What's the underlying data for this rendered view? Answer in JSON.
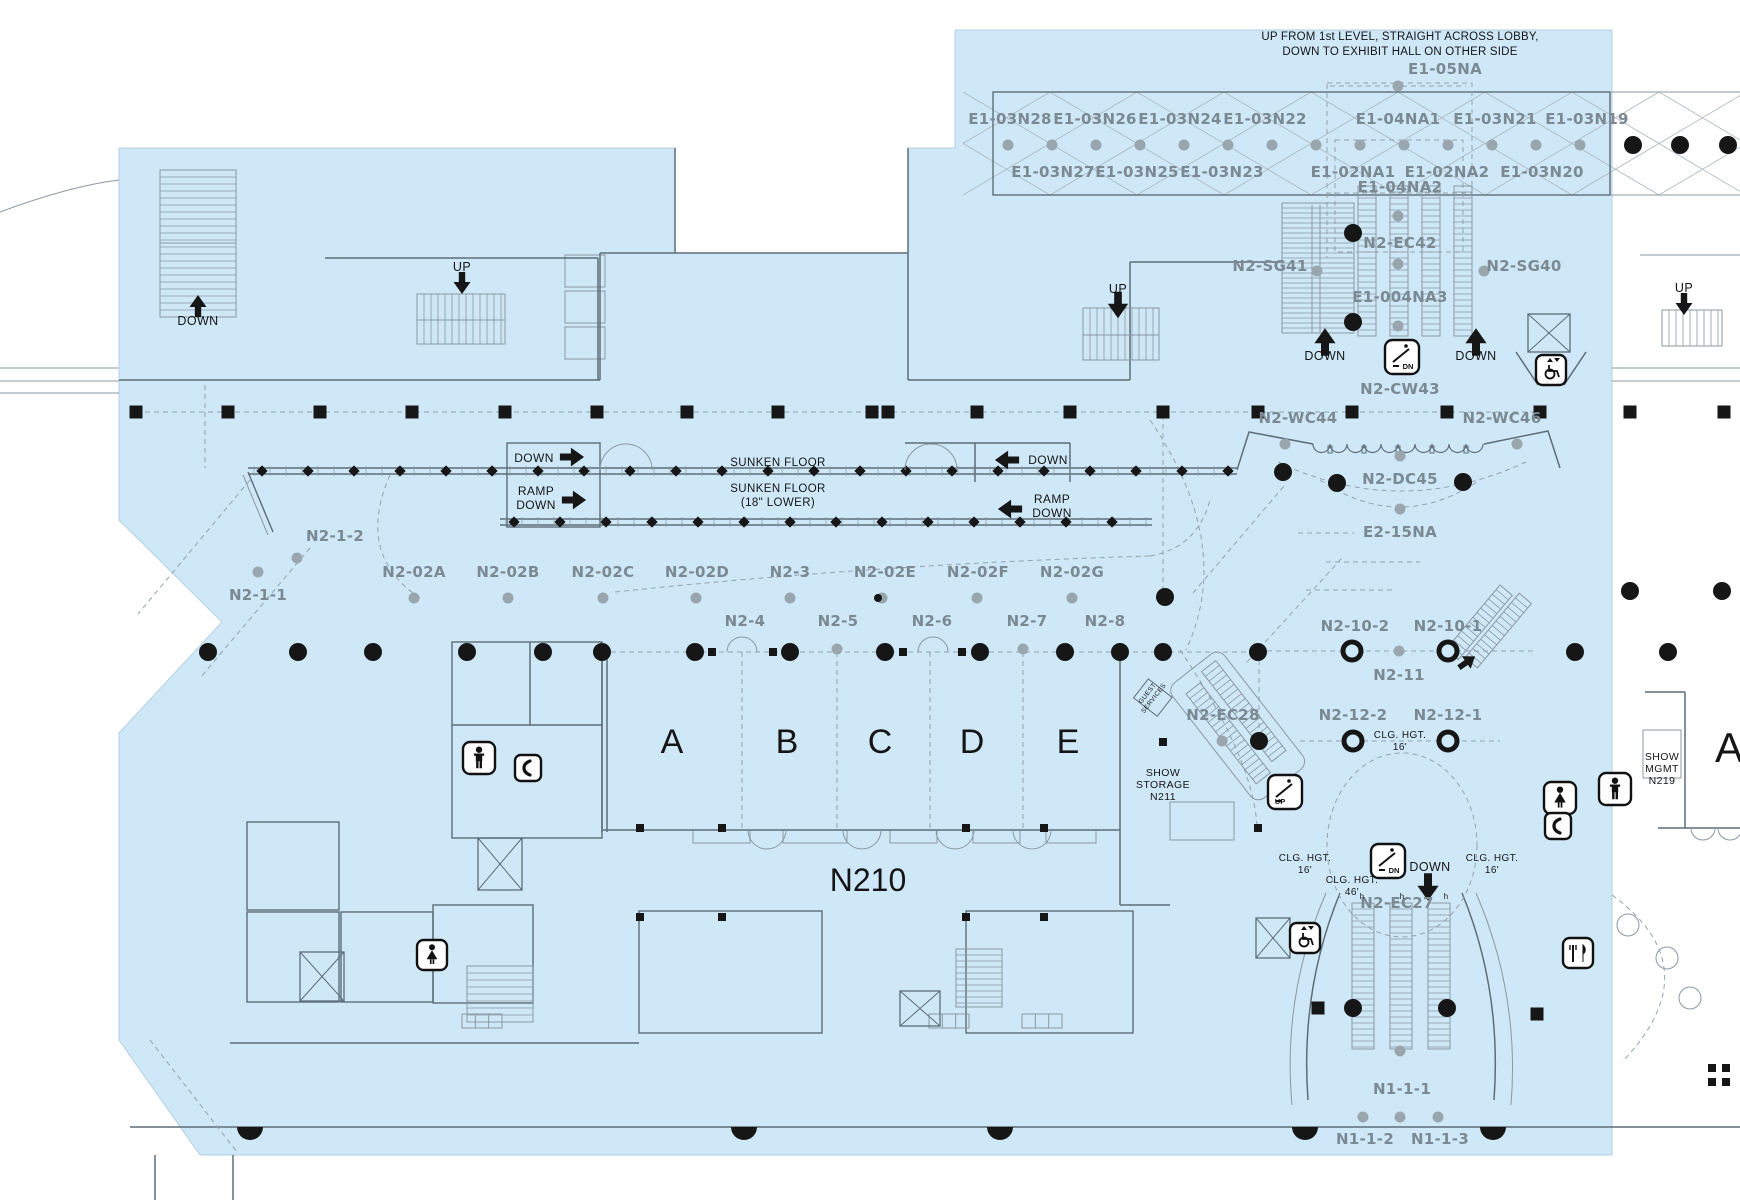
{
  "canvas": {
    "w": 1740,
    "h": 1200
  },
  "colors": {
    "floor": "#cfe8f8",
    "bg": "#ffffff",
    "wall": "#5d6d78",
    "line": "#8a98a2",
    "dash": "#93a2ab",
    "black": "#161616",
    "gray_label": "#7b8992",
    "dot": "#9aa6ad"
  },
  "header_note": {
    "line1": "UP FROM 1st LEVEL, STRAIGHT ACROSS LOBBY,",
    "line2": "DOWN TO EXHIBIT HALL ON OTHER SIDE"
  },
  "floor_polygon": [
    [
      119,
      148
    ],
    [
      675,
      148
    ],
    [
      675,
      253
    ],
    [
      908,
      253
    ],
    [
      908,
      148
    ],
    [
      955,
      148
    ],
    [
      955,
      30
    ],
    [
      1612,
      30
    ],
    [
      1612,
      1155
    ],
    [
      200,
      1155
    ],
    [
      119,
      1040
    ],
    [
      119,
      733
    ],
    [
      222,
      622
    ],
    [
      119,
      520
    ]
  ],
  "room_codes": [
    [
      "E1-05NA",
      1445,
      74
    ],
    [
      "E1-03N28",
      1010,
      124
    ],
    [
      "E1-03N26",
      1095,
      124
    ],
    [
      "E1-03N24",
      1180,
      124
    ],
    [
      "E1-03N22",
      1265,
      124
    ],
    [
      "E1-04NA1",
      1398,
      124
    ],
    [
      "E1-03N21",
      1495,
      124
    ],
    [
      "E1-03N19",
      1587,
      124
    ],
    [
      "E1-03N27",
      1053,
      177
    ],
    [
      "E1-03N25",
      1137,
      177
    ],
    [
      "E1-03N23",
      1222,
      177
    ],
    [
      "E1-02NA1",
      1353,
      177
    ],
    [
      "E1-02NA2",
      1447,
      177
    ],
    [
      "E1-03N20",
      1542,
      177
    ],
    [
      "E1-04NA2",
      1400,
      192
    ],
    [
      "N2-EC42",
      1400,
      248
    ],
    [
      "N2-SG41",
      1270,
      271
    ],
    [
      "N2-SG40",
      1524,
      271
    ],
    [
      "E1-004NA3",
      1400,
      302
    ],
    [
      "N2-CW43",
      1400,
      394
    ],
    [
      "N2-WC44",
      1298,
      423
    ],
    [
      "N2-WC46",
      1502,
      423
    ],
    [
      "N2-DC45",
      1400,
      484
    ],
    [
      "E2-15NA",
      1400,
      537
    ],
    [
      "N2-1-2",
      335,
      541
    ],
    [
      "N2-1-1",
      258,
      600
    ],
    [
      "N2-02A",
      414,
      577
    ],
    [
      "N2-02B",
      508,
      577
    ],
    [
      "N2-02C",
      603,
      577
    ],
    [
      "N2-02D",
      697,
      577
    ],
    [
      "N2-3",
      790,
      577
    ],
    [
      "N2-02E",
      885,
      577
    ],
    [
      "N2-02F",
      978,
      577
    ],
    [
      "N2-02G",
      1072,
      577
    ],
    [
      "N2-4",
      745,
      626
    ],
    [
      "N2-5",
      838,
      626
    ],
    [
      "N2-6",
      932,
      626
    ],
    [
      "N2-7",
      1027,
      626
    ],
    [
      "N2-8",
      1105,
      626
    ],
    [
      "N2-10-2",
      1355,
      631
    ],
    [
      "N2-10-1",
      1448,
      631
    ],
    [
      "N2-11",
      1399,
      680
    ],
    [
      "N2-12-2",
      1353,
      720
    ],
    [
      "N2-12-1",
      1448,
      720
    ],
    [
      "N2-EC28",
      1223,
      720
    ],
    [
      "N2-EC27",
      1397,
      908
    ],
    [
      "N1-1-1",
      1402,
      1094
    ],
    [
      "N1-1-2",
      1365,
      1144
    ],
    [
      "N1-1-3",
      1440,
      1144
    ]
  ],
  "way_labels": [
    [
      "DOWN",
      198,
      325,
      12.5
    ],
    [
      "UP",
      462,
      271,
      12.5
    ],
    [
      "UP",
      1118,
      293,
      12.5
    ],
    [
      "UP",
      1684,
      292,
      12.5
    ],
    [
      "DOWN",
      1325,
      360,
      12.5
    ],
    [
      "DOWN",
      1476,
      360,
      12.5
    ],
    [
      "DOWN",
      534,
      462,
      12
    ],
    [
      "RAMP",
      536,
      495,
      12
    ],
    [
      "DOWN",
      536,
      509,
      12
    ],
    [
      "SUNKEN FLOOR",
      778,
      466,
      11.5
    ],
    [
      "SUNKEN FLOOR",
      778,
      492,
      11.5
    ],
    [
      "(18\" LOWER)",
      778,
      506,
      11.5
    ],
    [
      "DOWN",
      1048,
      464,
      12
    ],
    [
      "RAMP",
      1052,
      503,
      12
    ],
    [
      "DOWN",
      1052,
      517,
      12
    ],
    [
      "SHOW",
      1163,
      776,
      10.5
    ],
    [
      "STORAGE",
      1163,
      788,
      10.5
    ],
    [
      "N211",
      1163,
      800,
      10.5
    ],
    [
      "CLG. HGT.",
      1400,
      738,
      10
    ],
    [
      "16'",
      1400,
      750,
      10
    ],
    [
      "CLG. HGT.",
      1305,
      861,
      10
    ],
    [
      "16'",
      1305,
      873,
      10
    ],
    [
      "CLG. HGT.",
      1352,
      883,
      10
    ],
    [
      "46'",
      1352,
      895,
      10
    ],
    [
      "CLG. HGT.",
      1492,
      861,
      10
    ],
    [
      "16'",
      1492,
      873,
      10
    ],
    [
      "DOWN",
      1430,
      871,
      12.5
    ],
    [
      "SHOW",
      1662,
      760,
      10.5
    ],
    [
      "MGMT",
      1662,
      772,
      10.5
    ],
    [
      "N219",
      1662,
      784,
      10.5
    ],
    [
      "h",
      1362,
      899,
      8
    ],
    [
      "h",
      1402,
      899,
      8
    ],
    [
      "h",
      1446,
      899,
      8
    ]
  ],
  "big_labels": [
    [
      "A",
      672,
      753,
      34
    ],
    [
      "B",
      787,
      753,
      34
    ],
    [
      "C",
      880,
      753,
      34
    ],
    [
      "D",
      972,
      753,
      34
    ],
    [
      "E",
      1068,
      753,
      34
    ],
    [
      "N210",
      868,
      891,
      32
    ],
    [
      "A",
      1729,
      762,
      42
    ]
  ],
  "rotated_labels": [
    {
      "lines": [
        "GUEST",
        "SERVICES"
      ],
      "x": 1152,
      "y": 697,
      "rotate": -52,
      "size": 6.5
    }
  ],
  "arrows": [
    [
      198,
      306,
      "up",
      1.0,
      0
    ],
    [
      462,
      283,
      "down",
      1.0,
      0
    ],
    [
      1118,
      305,
      "down",
      1.2,
      0
    ],
    [
      1684,
      304,
      "down",
      1.0,
      0
    ],
    [
      1325,
      342,
      "up",
      1.25,
      0
    ],
    [
      1476,
      342,
      "up",
      1.25,
      0
    ],
    [
      572,
      457,
      "right",
      1.1,
      0
    ],
    [
      574,
      500,
      "right",
      1.1,
      0
    ],
    [
      1007,
      460,
      "left",
      1.1,
      0
    ],
    [
      1010,
      509,
      "left",
      1.1,
      0
    ],
    [
      1428,
      887,
      "down",
      1.25,
      0
    ],
    [
      1467,
      662,
      "right",
      0.9,
      -35
    ]
  ],
  "icons": [
    {
      "type": "esc",
      "label": "DN",
      "x": 1402,
      "y": 357,
      "s": 34
    },
    {
      "type": "esc",
      "label": "UP",
      "x": 1285,
      "y": 792,
      "s": 34
    },
    {
      "type": "esc",
      "label": "DN",
      "x": 1388,
      "y": 861,
      "s": 34
    },
    {
      "type": "lift-acc",
      "x": 1551,
      "y": 370,
      "s": 30
    },
    {
      "type": "lift-acc",
      "x": 1305,
      "y": 938,
      "s": 30
    },
    {
      "type": "wc-men",
      "x": 479,
      "y": 758,
      "s": 32
    },
    {
      "type": "wc-men",
      "x": 1615,
      "y": 789,
      "s": 32
    },
    {
      "type": "wc-women",
      "x": 432,
      "y": 955,
      "s": 30
    },
    {
      "type": "wc-women",
      "x": 1560,
      "y": 798,
      "s": 32
    },
    {
      "type": "phone",
      "x": 528,
      "y": 768,
      "s": 26
    },
    {
      "type": "phone",
      "x": 1558,
      "y": 826,
      "s": 26
    },
    {
      "type": "food",
      "x": 1578,
      "y": 953,
      "s": 30
    }
  ],
  "elevators": [
    [
      1528,
      314,
      42,
      38
    ],
    [
      1256,
      918,
      34,
      40
    ],
    [
      478,
      838,
      44,
      52
    ],
    [
      900,
      991,
      40,
      35
    ],
    [
      300,
      952,
      44,
      49
    ]
  ],
  "stairs": [
    [
      160,
      170,
      76,
      147,
      "h",
      7
    ],
    [
      417,
      294,
      88,
      50,
      "v",
      7
    ],
    [
      1083,
      308,
      76,
      52,
      "v",
      7
    ],
    [
      1282,
      203,
      72,
      130,
      "h",
      5
    ],
    [
      1358,
      186,
      18,
      150,
      "h",
      6
    ],
    [
      1390,
      186,
      18,
      150,
      "h",
      6
    ],
    [
      1422,
      186,
      18,
      150,
      "h",
      6
    ],
    [
      1454,
      186,
      18,
      150,
      "h",
      6
    ],
    [
      1662,
      310,
      60,
      36,
      "v",
      7
    ],
    [
      467,
      966,
      66,
      56,
      "h",
      7
    ],
    [
      956,
      949,
      46,
      58,
      "h",
      6
    ],
    [
      1352,
      903,
      22,
      146,
      "h",
      6
    ],
    [
      1390,
      903,
      22,
      146,
      "h",
      6
    ],
    [
      1428,
      903,
      22,
      146,
      "h",
      6
    ]
  ],
  "stairs_rot": [
    {
      "x": 1186,
      "y": 694,
      "rot": -38,
      "bands": [
        [
          0,
          0,
          18,
          114
        ],
        [
          26,
          -8,
          18,
          114
        ]
      ],
      "step": 6,
      "outline": [
        -12,
        -16,
        66,
        146
      ]
    },
    {
      "x": 1500,
      "y": 585,
      "rot": 40,
      "bands": [
        [
          0,
          0,
          16,
          84
        ],
        [
          20,
          -6,
          16,
          84
        ]
      ],
      "step": 6,
      "outline": null
    }
  ],
  "columns": {
    "sq_size": 13,
    "squares": [
      [
        136,
        412
      ],
      [
        228,
        412
      ],
      [
        320,
        412
      ],
      [
        412,
        412
      ],
      [
        505,
        412
      ],
      [
        597,
        412
      ],
      [
        687,
        412
      ],
      [
        778,
        412
      ],
      [
        872,
        412
      ],
      [
        888,
        412
      ],
      [
        977,
        412
      ],
      [
        1070,
        412
      ],
      [
        1163,
        412
      ],
      [
        1258,
        412
      ],
      [
        1352,
        412
      ],
      [
        1447,
        412
      ],
      [
        1540,
        412
      ],
      [
        1630,
        412
      ],
      [
        1724,
        412
      ],
      [
        1318,
        1008
      ],
      [
        1537,
        1014
      ]
    ],
    "dot_r": 9,
    "dots": [
      [
        208,
        652
      ],
      [
        298,
        652
      ],
      [
        373,
        652
      ],
      [
        467,
        652
      ],
      [
        543,
        652
      ],
      [
        602,
        652
      ],
      [
        695,
        652
      ],
      [
        790,
        652
      ],
      [
        885,
        652
      ],
      [
        980,
        652
      ],
      [
        1065,
        652
      ],
      [
        1120,
        652
      ],
      [
        1163,
        652
      ],
      [
        1258,
        652
      ],
      [
        1353,
        233
      ],
      [
        1353,
        322
      ],
      [
        1283,
        472
      ],
      [
        1337,
        483
      ],
      [
        1463,
        482
      ],
      [
        1165,
        597
      ],
      [
        1259,
        741
      ],
      [
        1575,
        652
      ],
      [
        1668,
        652
      ],
      [
        1630,
        591
      ],
      [
        1722,
        591
      ],
      [
        1353,
        1008
      ],
      [
        1447,
        1008
      ],
      [
        1633,
        145
      ],
      [
        1680,
        145
      ],
      [
        1728,
        145
      ]
    ],
    "gray_r": 5.5,
    "gray_row_y145": [
      1008,
      1052,
      1096,
      1140,
      1184,
      1228,
      1272,
      1316,
      1360,
      1404,
      1448,
      1492,
      1536,
      1580
    ],
    "gray_row_y598": [
      414,
      508,
      603,
      696,
      790,
      882,
      977,
      1072
    ],
    "gray": [
      [
        1398,
        86
      ],
      [
        297,
        558
      ],
      [
        258,
        572
      ],
      [
        837,
        649
      ],
      [
        1023,
        649
      ],
      [
        1399,
        651
      ],
      [
        1317,
        271
      ],
      [
        1484,
        271
      ],
      [
        1398,
        216
      ],
      [
        1398,
        264
      ],
      [
        1398,
        326
      ],
      [
        1285,
        444
      ],
      [
        1400,
        456
      ],
      [
        1517,
        444
      ],
      [
        1400,
        509
      ],
      [
        1222,
        741
      ],
      [
        1400,
        1051
      ],
      [
        1363,
        1117
      ],
      [
        1400,
        1117
      ],
      [
        1438,
        1117
      ]
    ],
    "rings": [
      [
        1352,
        651
      ],
      [
        1448,
        651
      ],
      [
        1353,
        741
      ],
      [
        1448,
        741
      ]
    ],
    "small_squares": [
      [
        640,
        828
      ],
      [
        722,
        828
      ],
      [
        966,
        828
      ],
      [
        1044,
        828
      ],
      [
        1258,
        828
      ],
      [
        640,
        917
      ],
      [
        722,
        917
      ],
      [
        966,
        917
      ],
      [
        1044,
        917
      ],
      [
        1163,
        742
      ],
      [
        712,
        652
      ],
      [
        773,
        652
      ],
      [
        903,
        652
      ],
      [
        962,
        652
      ],
      [
        1712,
        1068
      ],
      [
        1726,
        1068
      ],
      [
        1712,
        1082
      ],
      [
        1726,
        1082
      ]
    ],
    "tiny_black": [
      [
        878,
        598
      ]
    ],
    "half_domes": [
      [
        250,
        1127
      ],
      [
        744,
        1127
      ],
      [
        1000,
        1127
      ],
      [
        1305,
        1127
      ],
      [
        1493,
        1127
      ]
    ]
  },
  "walls": {
    "heavy": [
      "M119,380 H600",
      "M600,380 V253",
      "M600,253 H908",
      "M908,253 V380",
      "M908,380 H1130",
      "M675,148 V253",
      "M908,148 V253",
      "M325,258 H598",
      "M598,258 V380",
      "M1130,380 V262",
      "M1130,262 H1282",
      "M452,725 H602",
      "M530,642 V725",
      "M602,652 V832",
      "M607,652 V832",
      "M602,830 H1120",
      "M1120,652 V905",
      "M1120,905 H1170",
      "M230,1043 H639",
      "M1237,470 L1249,432 L1313,444",
      "M1484,444 L1548,431 L1560,468",
      "M1340,893 Q1300,990 1308,1100",
      "M1462,893 Q1502,990 1494,1100",
      "M905,443 H1070",
      "M975,443 V482",
      "M1070,443 V482",
      "M155,1155 V1200",
      "M233,1155 V1200",
      "M1685,692 V828",
      "M1645,692 H1685",
      "M1658,828 H1740",
      "M1516,352 L1538,385",
      "M1586,352 L1564,385",
      "M130,1127 H1740"
    ],
    "light": [
      "M0,368 H119",
      "M0,381 H119",
      "M0,393 H119",
      "M0,212 Q70,186 119,180",
      "M1612,368 H1740",
      "M1612,381 H1740",
      "M1610,92 H1740",
      "M1610,195 H1740",
      "M1312,205 V333",
      "M1320,205 V333",
      "M160,243 H236",
      "M417,320 H505",
      "M1083,335 H1159",
      "M1326,893 Q1282,995 1292,1105",
      "M1476,893 Q1520,995 1511,1105",
      "M1640,255 H1740"
    ],
    "rects": [
      [
        452,
        642,
        150,
        196
      ],
      [
        639,
        911,
        183,
        122
      ],
      [
        966,
        911,
        167,
        122
      ],
      [
        247,
        822,
        92,
        88
      ],
      [
        247,
        912,
        92,
        90
      ],
      [
        341,
        912,
        92,
        90
      ],
      [
        433,
        905,
        100,
        98
      ],
      [
        507,
        443,
        93,
        84
      ],
      [
        993,
        92,
        617,
        103
      ]
    ],
    "rects_light": [
      [
        693,
        830,
        57,
        13
      ],
      [
        783,
        830,
        64,
        13
      ],
      [
        890,
        830,
        47,
        13
      ],
      [
        973,
        830,
        47,
        13
      ],
      [
        1046,
        830,
        50,
        13
      ],
      [
        565,
        255,
        40,
        32
      ],
      [
        565,
        291,
        40,
        32
      ],
      [
        565,
        327,
        40,
        32
      ],
      [
        1170,
        802,
        64,
        38
      ],
      [
        1643,
        730,
        38,
        48
      ]
    ],
    "dashed": [
      "M136,412 H1540",
      "M602,652 H1258",
      "M742,652 V830",
      "M837,652 V830",
      "M930,652 V830",
      "M1023,652 V830",
      "M1163,415 V595",
      "M1258,651 H1535",
      "M1259,651 V739",
      "M1300,741 H1500",
      "M390,475 Q355,555 420,598",
      "M615,592 Q880,564 1150,556",
      "M1150,556 Q1197,548 1210,500",
      "M250,480 L138,614",
      "M310,548 L200,678",
      "M1150,420 Q1235,545 1186,650",
      "M1320,480 Q1400,534 1480,480",
      "M1278,462 Q1400,520 1526,462",
      "M1298,533 H1354",
      "M1326,562 H1420",
      "M1306,590 H1392",
      "M1193,593 L1284,486",
      "M1247,662 L1342,558",
      "M1180,650 Q1252,756 1257,825",
      "M150,1040 L237,1152",
      "M1612,895 Q1712,968 1622,1062",
      "M205,385 V468",
      "M1330,86 H1466",
      "M1327,193 V258",
      "M1472,193 V258"
    ],
    "dashed_rects": [
      [
        1327,
        83,
        145,
        110
      ],
      [
        1335,
        140,
        128,
        112
      ]
    ]
  },
  "lattice": {
    "x1": 963,
    "x2": 1740,
    "y1": 92,
    "y2": 195,
    "step": 87
  },
  "scallops": {
    "x1": 1313,
    "x2": 1484,
    "y": 444,
    "r": 8.5
  },
  "sunken": {
    "north": {
      "x1": 248,
      "x2": 1237,
      "y": 470
    },
    "south": {
      "x1": 500,
      "x2": 1152,
      "y": 522
    },
    "diag": [
      [
        248,
        472,
        273,
        532
      ]
    ],
    "diamond_step": 46,
    "tick_step": 16
  },
  "ellipse_dashed": [
    [
      1402,
      845,
      75,
      92
    ]
  ],
  "circles_light": [
    [
      1628,
      925,
      11
    ],
    [
      1667,
      958,
      11
    ],
    [
      1690,
      998,
      11
    ]
  ],
  "grids": [
    [
      462,
      1014,
      40,
      14,
      3
    ],
    [
      929,
      1014,
      40,
      14,
      3
    ],
    [
      1022,
      1014,
      40,
      14,
      3
    ]
  ],
  "double_doors": [
    [
      626,
      470,
      26,
      "up"
    ],
    [
      931,
      470,
      26,
      "up"
    ],
    [
      742,
      652,
      15,
      "up"
    ],
    [
      933,
      652,
      15,
      "up"
    ],
    [
      767,
      830,
      19,
      "down"
    ],
    [
      862,
      830,
      19,
      "down"
    ],
    [
      955,
      830,
      19,
      "down"
    ],
    [
      1032,
      830,
      19,
      "down"
    ],
    [
      1703,
      828,
      12,
      "down"
    ],
    [
      1730,
      828,
      12,
      "down"
    ]
  ]
}
